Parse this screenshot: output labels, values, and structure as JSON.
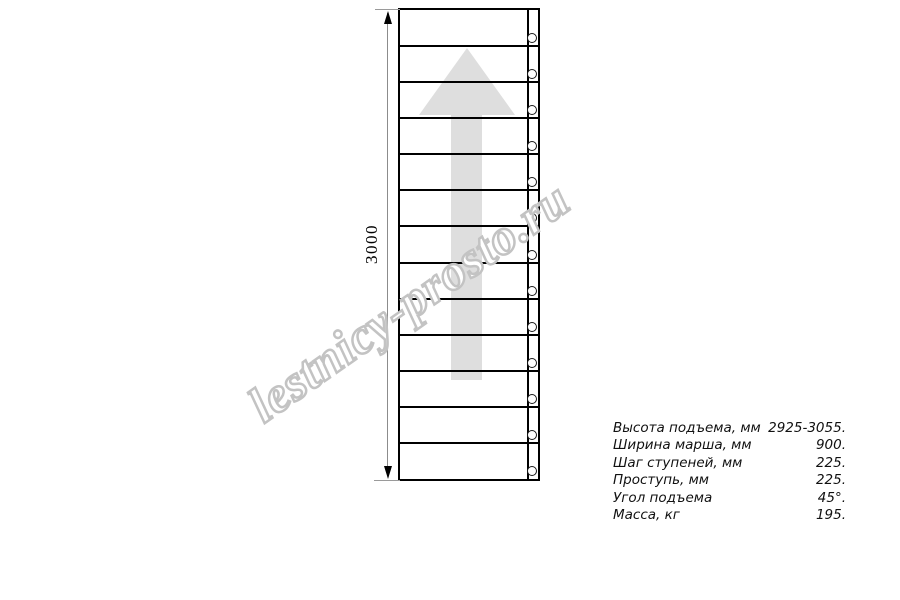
{
  "page": {
    "background": "#ffffff"
  },
  "drawing": {
    "dimension_label": "3000",
    "steps_count": 13,
    "arrow_direction": "up",
    "line_color": "#000000",
    "arrow_color": "#dedede"
  },
  "watermark": {
    "text": "lestnicy-prosto.ru",
    "outline_color": "#c3c3c3"
  },
  "specs": {
    "rows": [
      {
        "label": "Высота подъема, мм",
        "value": "2925-3055."
      },
      {
        "label": "Ширина марша, мм",
        "value": "900."
      },
      {
        "label": "Шаг ступеней, мм",
        "value": "225."
      },
      {
        "label": "Проступь, мм",
        "value": "225."
      },
      {
        "label": "Угол подъема",
        "value": "45°."
      },
      {
        "label": "Масса, кг",
        "value": "195."
      }
    ]
  }
}
